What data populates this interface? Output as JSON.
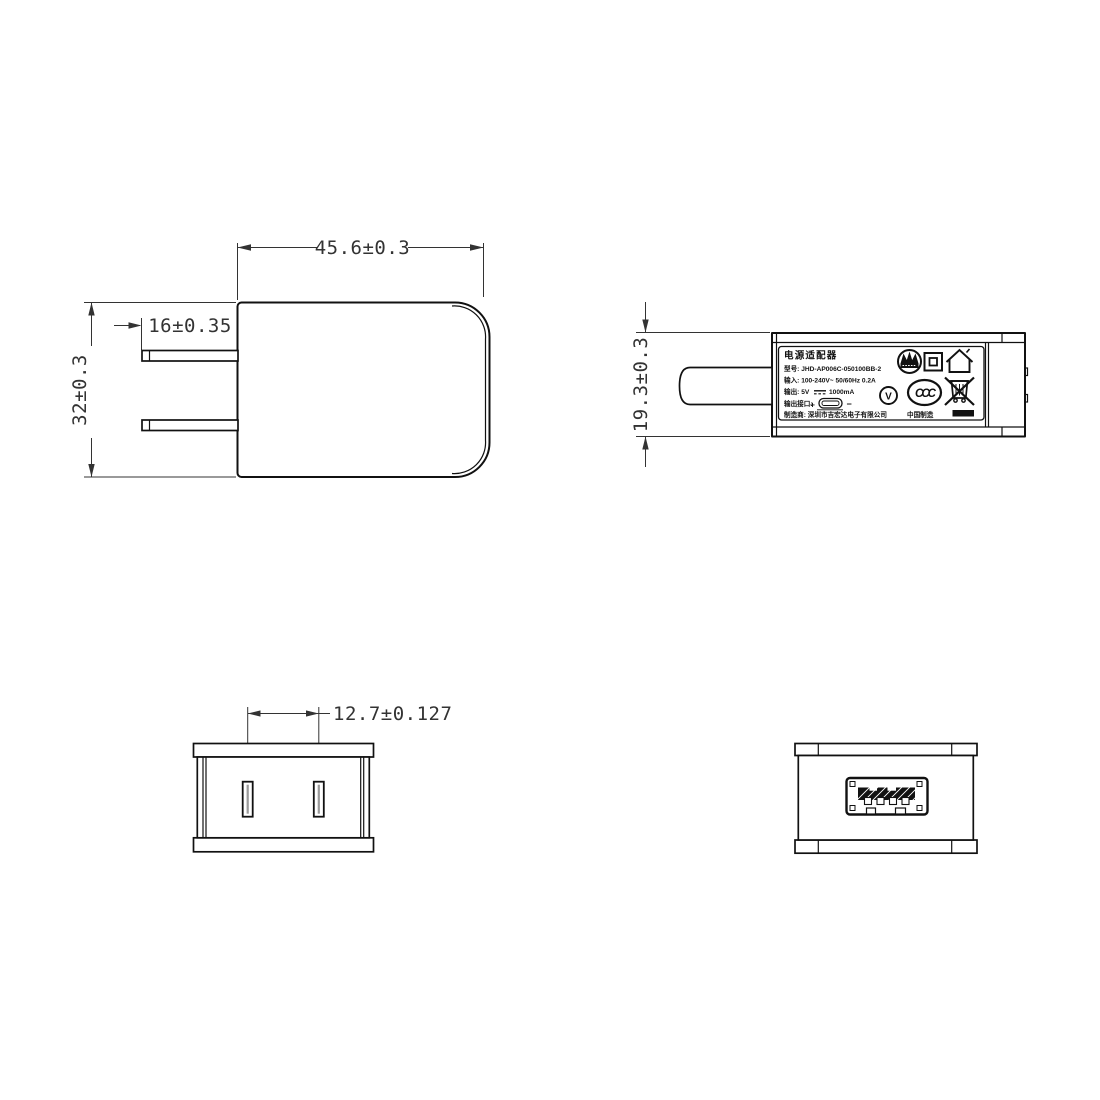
{
  "front_view": {
    "width_dim": "45.6±0.3",
    "prong_length_dim": "16±0.35",
    "height_dim": "32±0.3"
  },
  "side_view": {
    "thickness_dim": "19.3±0.3",
    "label": {
      "title": "电源适配器",
      "model_line": "型号: JHD-AP006C-050100BB-2",
      "input_line": "输入: 100-240V~ 50/60Hz 0.2A",
      "output_prefix": "输出: 5V",
      "output_suffix": "1000mA",
      "port_prefix": "输出接口:",
      "polarity_plus": "+",
      "polarity_minus": "−",
      "manufacturer_line": "制造商: 深圳市吉宏达电子有限公司",
      "made_in": "中国制造",
      "efficiency_letter": "V",
      "ccc_text": "CCC"
    }
  },
  "bottom_plug_view": {
    "prong_spacing_dim": "12.7±0.127"
  },
  "colors": {
    "line": "#111111",
    "dimension": "#333333",
    "background": "#ffffff"
  }
}
